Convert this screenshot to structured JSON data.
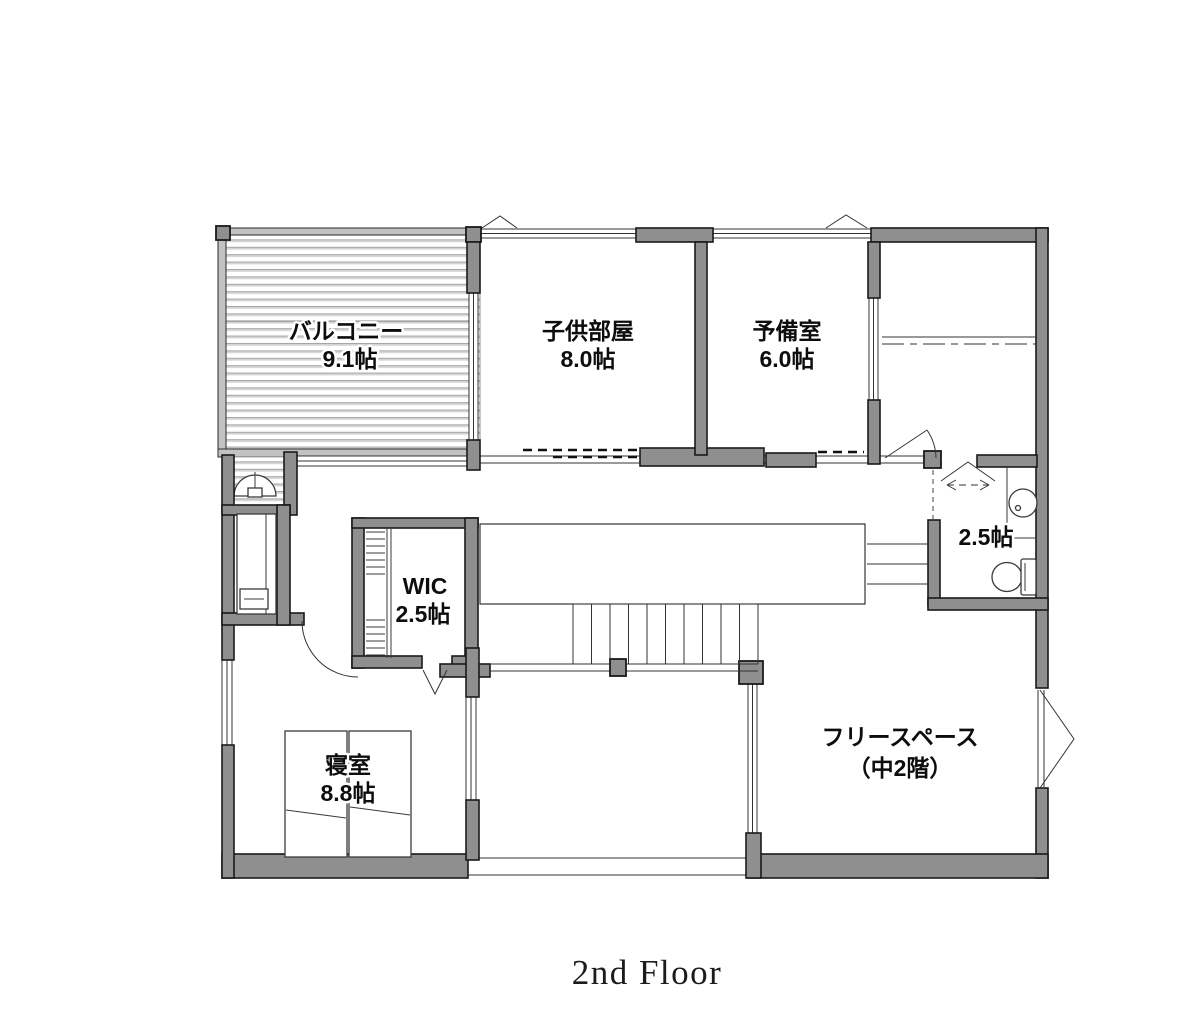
{
  "meta": {
    "caption": "2nd Floor"
  },
  "colors": {
    "wall": "#8f8f8f",
    "wall_outline": "#1a1a1a",
    "balcony_stripe": "#d4d4d4",
    "line": "#333333",
    "text": "#0d0d0d"
  },
  "rooms": {
    "balcony": {
      "name": "バルコニー",
      "area": "9.1帖"
    },
    "kids_room": {
      "name": "子供部屋",
      "area": "8.0帖"
    },
    "spare_room": {
      "name": "予備室",
      "area": "6.0帖"
    },
    "wic": {
      "name": "WIC",
      "area": "2.5帖"
    },
    "washroom": {
      "area": "2.5帖"
    },
    "bedroom": {
      "name": "寝室",
      "area": "8.8帖"
    },
    "free_space": {
      "name": "フリースペース",
      "sub": "（中2階）"
    }
  }
}
